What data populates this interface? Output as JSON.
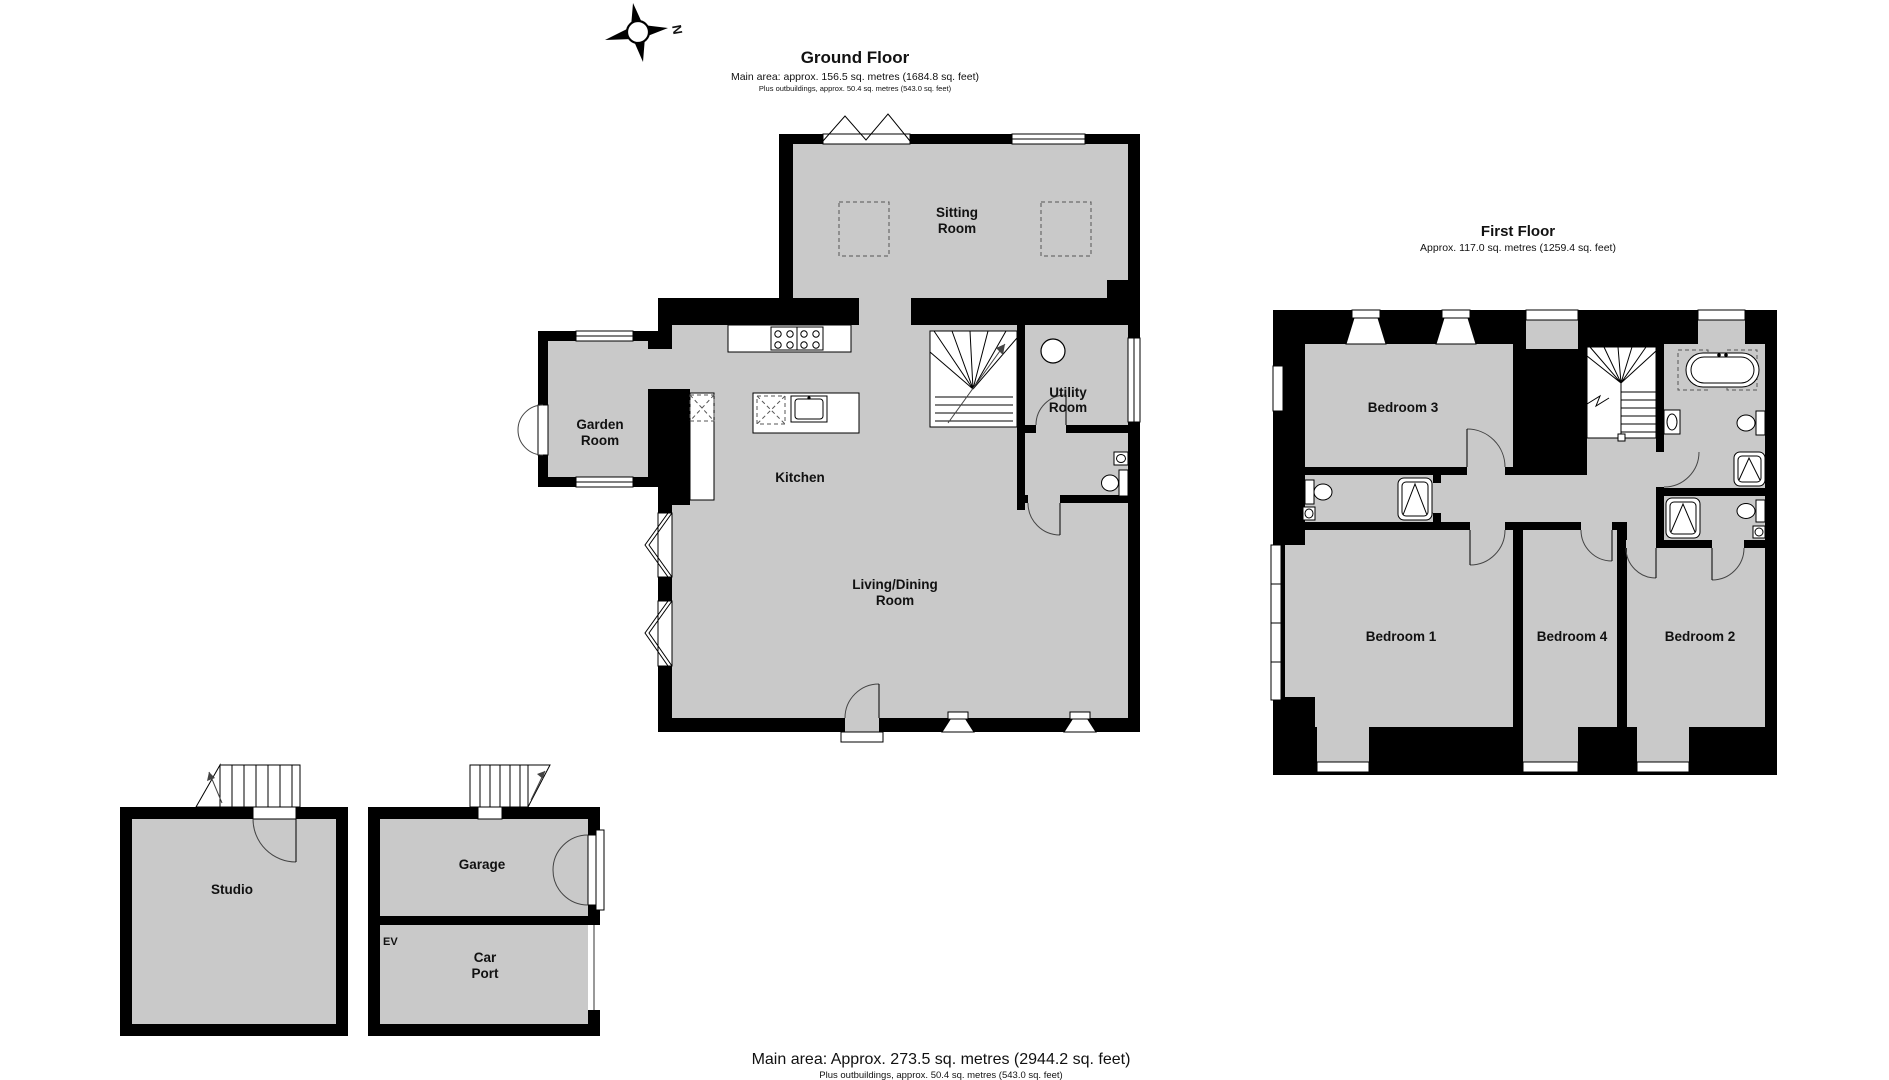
{
  "compass": {
    "north_label": "N"
  },
  "ground_floor": {
    "title": "Ground Floor",
    "area_line": "Main area: approx. 156.5 sq. metres (1684.8 sq. feet)",
    "outbuildings_line": "Plus outbuildings, approx. 50.4 sq. metres (543.0 sq. feet)",
    "rooms": {
      "sitting_room": [
        "Sitting",
        "Room"
      ],
      "garden_room": [
        "Garden",
        "Room"
      ],
      "kitchen": [
        "Kitchen"
      ],
      "utility_room": [
        "Utility",
        "Room"
      ],
      "living_dining_room": [
        "Living/Dining",
        "Room"
      ]
    }
  },
  "first_floor": {
    "title": "First Floor",
    "area_line": "Approx. 117.0 sq. metres (1259.4 sq. feet)",
    "rooms": {
      "bedroom_3": [
        "Bedroom 3"
      ],
      "bedroom_1": [
        "Bedroom 1"
      ],
      "bedroom_4": [
        "Bedroom 4"
      ],
      "bedroom_2": [
        "Bedroom 2"
      ]
    }
  },
  "outbuildings": {
    "rooms": {
      "studio": [
        "Studio"
      ],
      "garage": [
        "Garage"
      ],
      "ev": [
        "EV"
      ],
      "car_port": [
        "Car",
        "Port"
      ]
    }
  },
  "footer": {
    "main_area_line": "Main area: Approx. 273.5 sq. metres (2944.2 sq. feet)",
    "outbuildings_line": "Plus outbuildings, approx. 50.4 sq. metres (543.0 sq. feet)"
  },
  "colors": {
    "wall": "#000000",
    "floor_fill": "#c9c9c9",
    "background": "#ffffff"
  }
}
